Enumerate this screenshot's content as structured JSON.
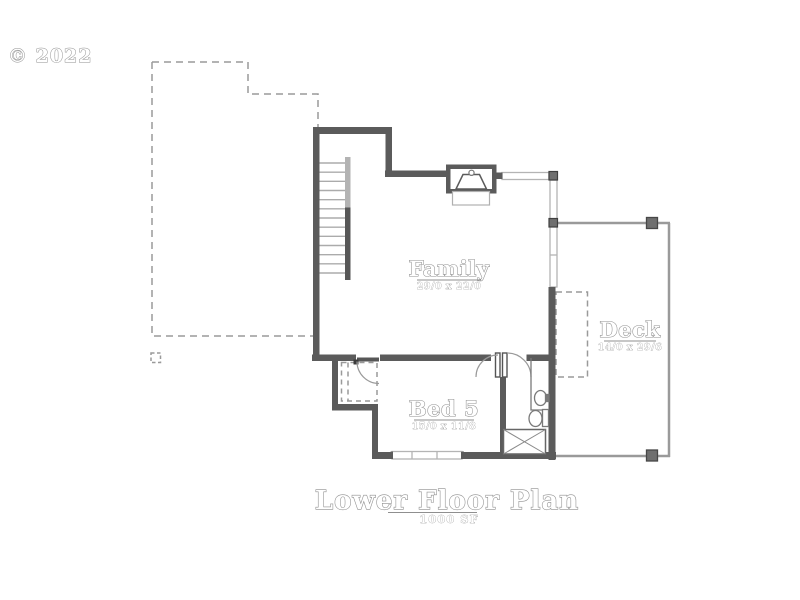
{
  "copyright": "© 2022",
  "rooms": [
    {
      "name": "Family",
      "dims": "29/0 x 22/0"
    },
    {
      "name": "Deck",
      "dims": "14/0 x 29/6"
    },
    {
      "name": "Bed 5",
      "dims": "15/0 x 11/8"
    }
  ],
  "title": {
    "text": "Lower Floor Plan",
    "area": "1000 SF"
  },
  "colors": {
    "wall": "#5b5b5b",
    "post": "#6f6f6f",
    "thin_line": "#9a9a9a",
    "window": "#b4b4b4",
    "tread": "#ababab",
    "fixture": "#7a7a7a",
    "text": "#8f8f8f",
    "background": "#ffffff"
  }
}
